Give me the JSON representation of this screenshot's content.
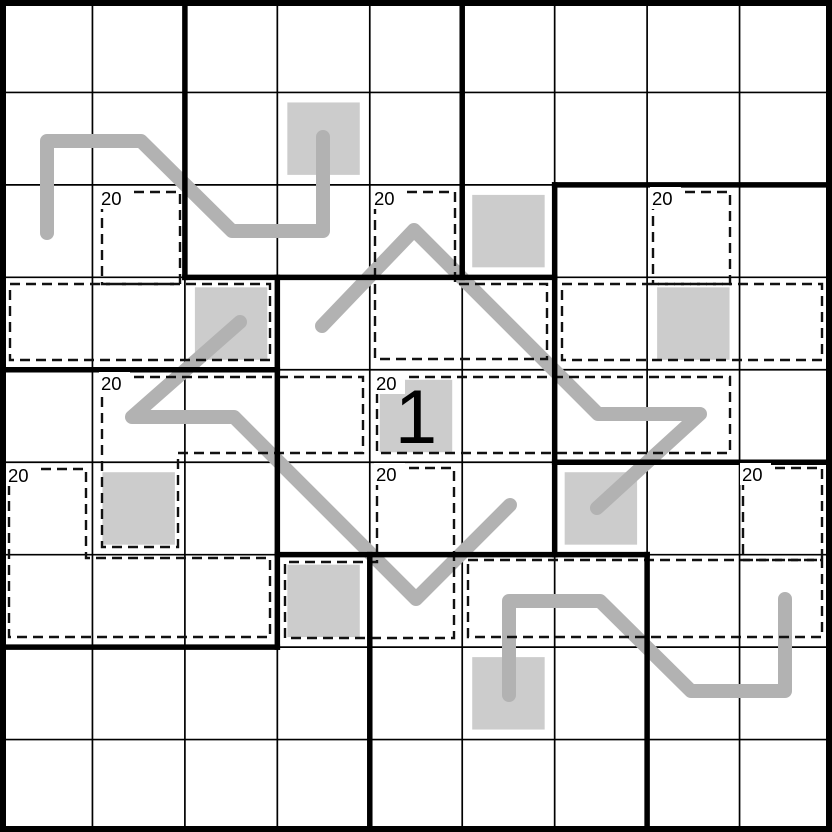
{
  "puzzle": {
    "grid": {
      "rows": 9,
      "cols": 9,
      "size_px": 832
    },
    "colors": {
      "background": "#ffffff",
      "grid_line": "#000000",
      "region_border": "#000000",
      "cage_border": "#111111",
      "shaded_cell": "#cccccc",
      "snake_line": "#b2b2b2",
      "label_text": "#000000",
      "given_text": "#000000"
    },
    "cages": [
      {
        "label": "20",
        "cells": [
          [
            2,
            1
          ],
          [
            3,
            0
          ],
          [
            3,
            1
          ],
          [
            3,
            2
          ]
        ],
        "outlines": [
          [
            [
              102,
              192
            ],
            [
              180,
              192
            ],
            [
              180,
              284
            ],
            [
              102,
              284
            ]
          ],
          [
            [
              10,
              284
            ],
            [
              270,
              284
            ],
            [
              270,
              360
            ],
            [
              10,
              360
            ]
          ]
        ]
      },
      {
        "label": "20",
        "cells": [
          [
            2,
            4
          ],
          [
            3,
            4
          ],
          [
            3,
            5
          ]
        ],
        "outlines": [
          [
            [
              375,
              192
            ],
            [
              455,
              192
            ],
            [
              455,
              284
            ],
            [
              547,
              284
            ],
            [
              547,
              359
            ],
            [
              375,
              359
            ]
          ]
        ]
      },
      {
        "label": "20",
        "cells": [
          [
            2,
            7
          ],
          [
            3,
            6
          ],
          [
            3,
            7
          ],
          [
            3,
            8
          ]
        ],
        "outlines": [
          [
            [
              653,
              192
            ],
            [
              730,
              192
            ],
            [
              730,
              284
            ],
            [
              653,
              284
            ]
          ],
          [
            [
              562,
              284
            ],
            [
              822,
              284
            ],
            [
              822,
              360
            ],
            [
              562,
              360
            ]
          ]
        ]
      },
      {
        "label": "20",
        "cells": [
          [
            4,
            1
          ],
          [
            4,
            2
          ],
          [
            4,
            3
          ],
          [
            5,
            1
          ]
        ],
        "outlines": [
          [
            [
              102,
              377
            ],
            [
              363,
              377
            ],
            [
              363,
              453
            ],
            [
              178,
              453
            ],
            [
              178,
              547
            ],
            [
              102,
              547
            ]
          ]
        ]
      },
      {
        "label": "20",
        "cells": [
          [
            4,
            4
          ],
          [
            4,
            5
          ],
          [
            4,
            6
          ],
          [
            4,
            7
          ]
        ],
        "outlines": [
          [
            [
              377,
              377
            ],
            [
              730,
              377
            ],
            [
              730,
              453
            ],
            [
              377,
              453
            ]
          ]
        ]
      },
      {
        "label": "20",
        "cells": [
          [
            5,
            0
          ],
          [
            6,
            0
          ],
          [
            6,
            1
          ],
          [
            6,
            2
          ]
        ],
        "outlines": [
          [
            [
              9,
              469
            ],
            [
              86,
              469
            ],
            [
              86,
              558
            ],
            [
              270,
              558
            ],
            [
              270,
              637
            ],
            [
              9,
              637
            ]
          ]
        ]
      },
      {
        "label": "20",
        "cells": [
          [
            5,
            4
          ],
          [
            6,
            3
          ],
          [
            6,
            4
          ]
        ],
        "outlines": [
          [
            [
              377,
              468
            ],
            [
              454,
              468
            ],
            [
              454,
              638
            ],
            [
              285,
              638
            ],
            [
              285,
              562
            ],
            [
              377,
              562
            ]
          ]
        ]
      },
      {
        "label": "20",
        "cells": [
          [
            5,
            8
          ],
          [
            6,
            5
          ],
          [
            6,
            6
          ],
          [
            6,
            7
          ],
          [
            6,
            8
          ]
        ],
        "outlines": [
          [
            [
              743,
              468
            ],
            [
              822,
              468
            ],
            [
              822,
              560
            ],
            [
              743,
              560
            ]
          ],
          [
            [
              468,
              560
            ],
            [
              822,
              560
            ],
            [
              822,
              637
            ],
            [
              468,
              637
            ]
          ]
        ]
      }
    ],
    "shaded_cells": [
      [
        1,
        3
      ],
      [
        2,
        5
      ],
      [
        3,
        2
      ],
      [
        3,
        7
      ],
      [
        4,
        4
      ],
      [
        5,
        1
      ],
      [
        5,
        6
      ],
      [
        6,
        3
      ],
      [
        7,
        5
      ]
    ],
    "snake_lines": [
      {
        "points": [
          [
            47,
            233
          ],
          [
            47,
            141
          ],
          [
            141,
            141
          ],
          [
            232,
            231
          ],
          [
            323,
            231
          ],
          [
            323,
            137
          ]
        ]
      },
      {
        "points": [
          [
            240,
            322
          ],
          [
            132,
            417
          ],
          [
            234,
            417
          ],
          [
            416,
            599
          ],
          [
            510,
            505
          ]
        ]
      },
      {
        "points": [
          [
            597,
            508
          ],
          [
            700,
            414
          ],
          [
            598,
            414
          ],
          [
            414,
            230
          ],
          [
            322,
            326
          ]
        ]
      },
      {
        "points": [
          [
            785,
            599
          ],
          [
            785,
            691
          ],
          [
            691,
            691
          ],
          [
            600,
            601
          ],
          [
            509,
            601
          ],
          [
            509,
            695
          ]
        ]
      }
    ],
    "region_borders": [
      {
        "x1": 2,
        "y1": 0,
        "x2": 2,
        "y2": 3
      },
      {
        "x1": 5,
        "y1": 0,
        "x2": 5,
        "y2": 3
      },
      {
        "x1": 2,
        "y1": 3,
        "x2": 6,
        "y2": 3
      },
      {
        "x1": 6,
        "y1": 2,
        "x2": 9,
        "y2": 2
      },
      {
        "x1": 6,
        "y1": 2,
        "x2": 6,
        "y2": 6
      },
      {
        "x1": 6,
        "y1": 5,
        "x2": 9,
        "y2": 5
      },
      {
        "x1": 0,
        "y1": 4,
        "x2": 3,
        "y2": 4
      },
      {
        "x1": 3,
        "y1": 3,
        "x2": 3,
        "y2": 7
      },
      {
        "x1": 0,
        "y1": 7,
        "x2": 3,
        "y2": 7
      },
      {
        "x1": 3,
        "y1": 6,
        "x2": 7,
        "y2": 6
      },
      {
        "x1": 4,
        "y1": 6,
        "x2": 4,
        "y2": 9
      },
      {
        "x1": 7,
        "y1": 6,
        "x2": 7,
        "y2": 9
      }
    ],
    "given_digits": [
      {
        "row": 4,
        "col": 4,
        "value": "1"
      }
    ]
  }
}
